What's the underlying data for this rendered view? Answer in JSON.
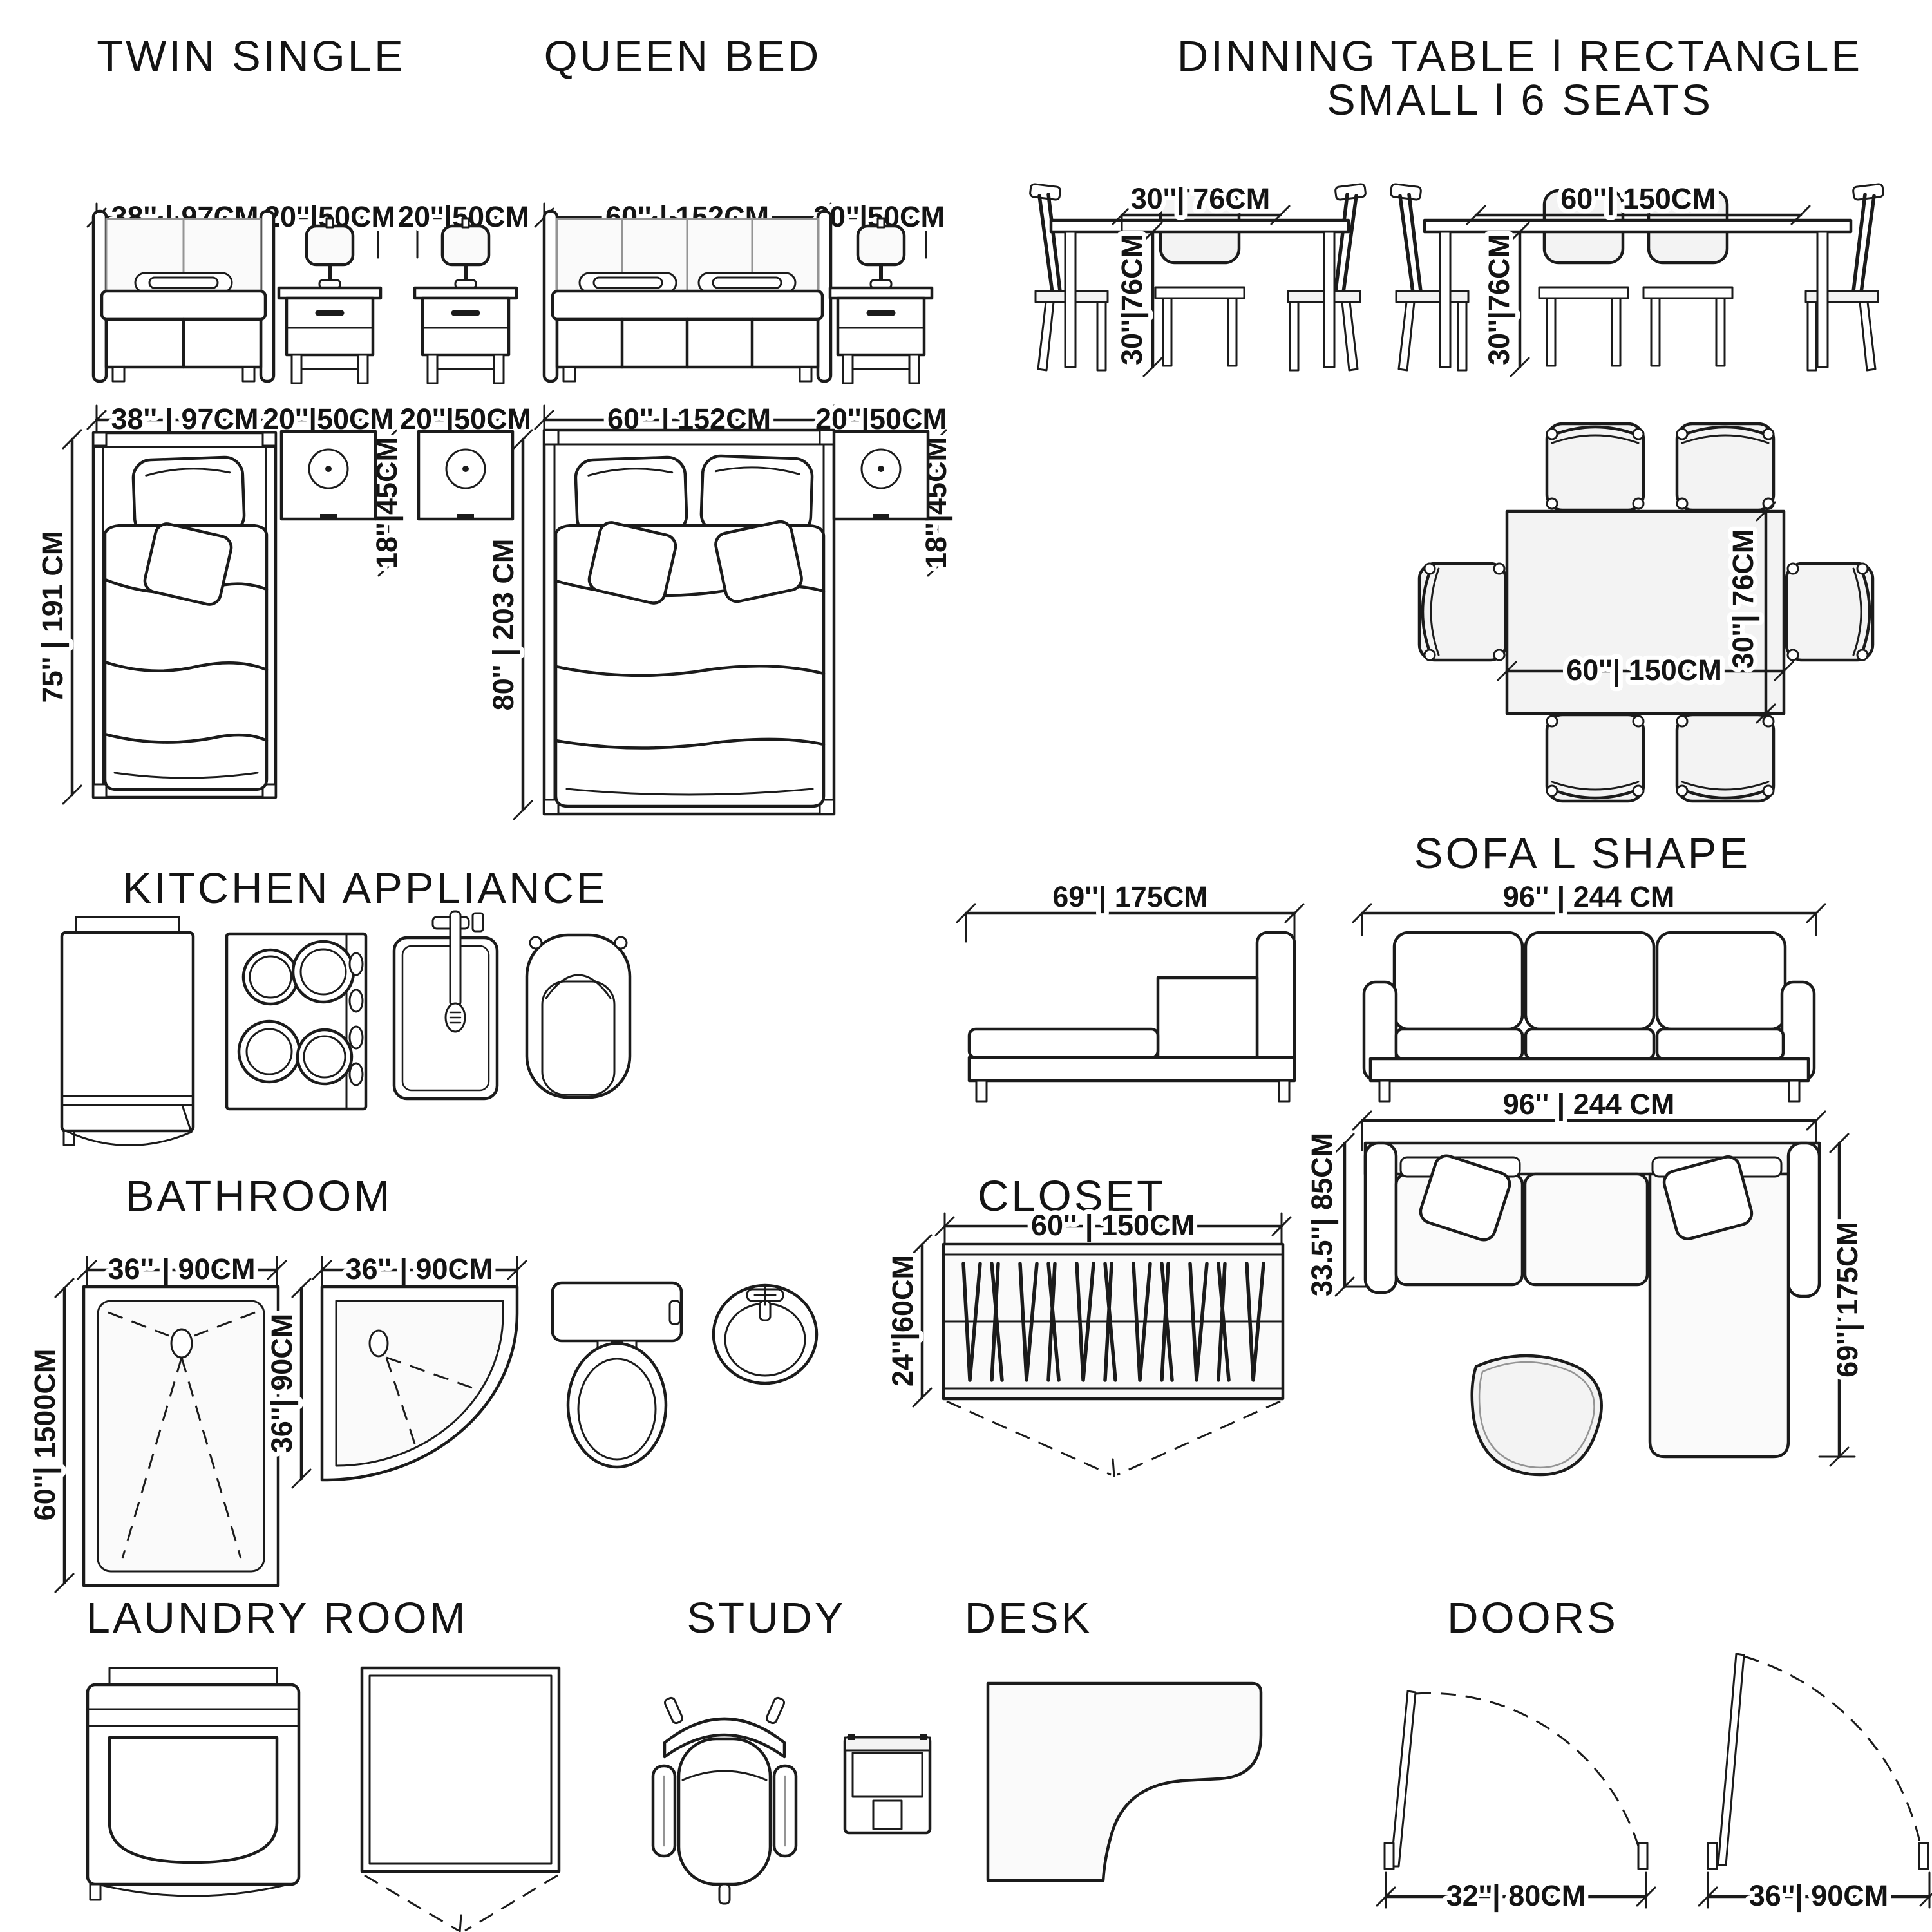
{
  "titles": {
    "twin_single": "TWIN SINGLE",
    "queen_bed": "QUEEN BED",
    "dining_line1": "DINNING TABLE l RECTANGLE",
    "dining_line2": "SMALL l 6 SEATS",
    "kitchen": "KITCHEN APPLIANCE",
    "sofa": "SOFA L SHAPE",
    "bathroom": "BATHROOM",
    "closet": "CLOSET",
    "laundry": "LAUNDRY ROOM",
    "study": "STUDY",
    "desk": "DESK",
    "doors": "DOORS"
  },
  "dims": {
    "twin": {
      "width": "38''  |  97CM",
      "length": "75''  |  191 CM"
    },
    "queen": {
      "width": "60''  |  152CM",
      "length": "80''  |  203 CM"
    },
    "nightstand": {
      "width": "20''|50CM",
      "depth": "18''|45CM"
    },
    "dining": {
      "small_width": "30''|  76CM",
      "seat_height": "30''|76CM",
      "large_width": "60''|  150CM"
    },
    "sofa": {
      "chaise": "69''|  175CM",
      "width": "96''  |  244 CM",
      "depth": "33.5''|  85CM"
    },
    "bathroom": {
      "shower_width": "36''  |  90CM",
      "shower_length": "60''|  1500CM",
      "corner_depth": "36''|  90CM"
    },
    "closet": {
      "width": "60''  |  150CM",
      "depth": "24''|60CM"
    },
    "doors": {
      "small": "32''|  80CM",
      "large": "36''|  90CM"
    }
  }
}
